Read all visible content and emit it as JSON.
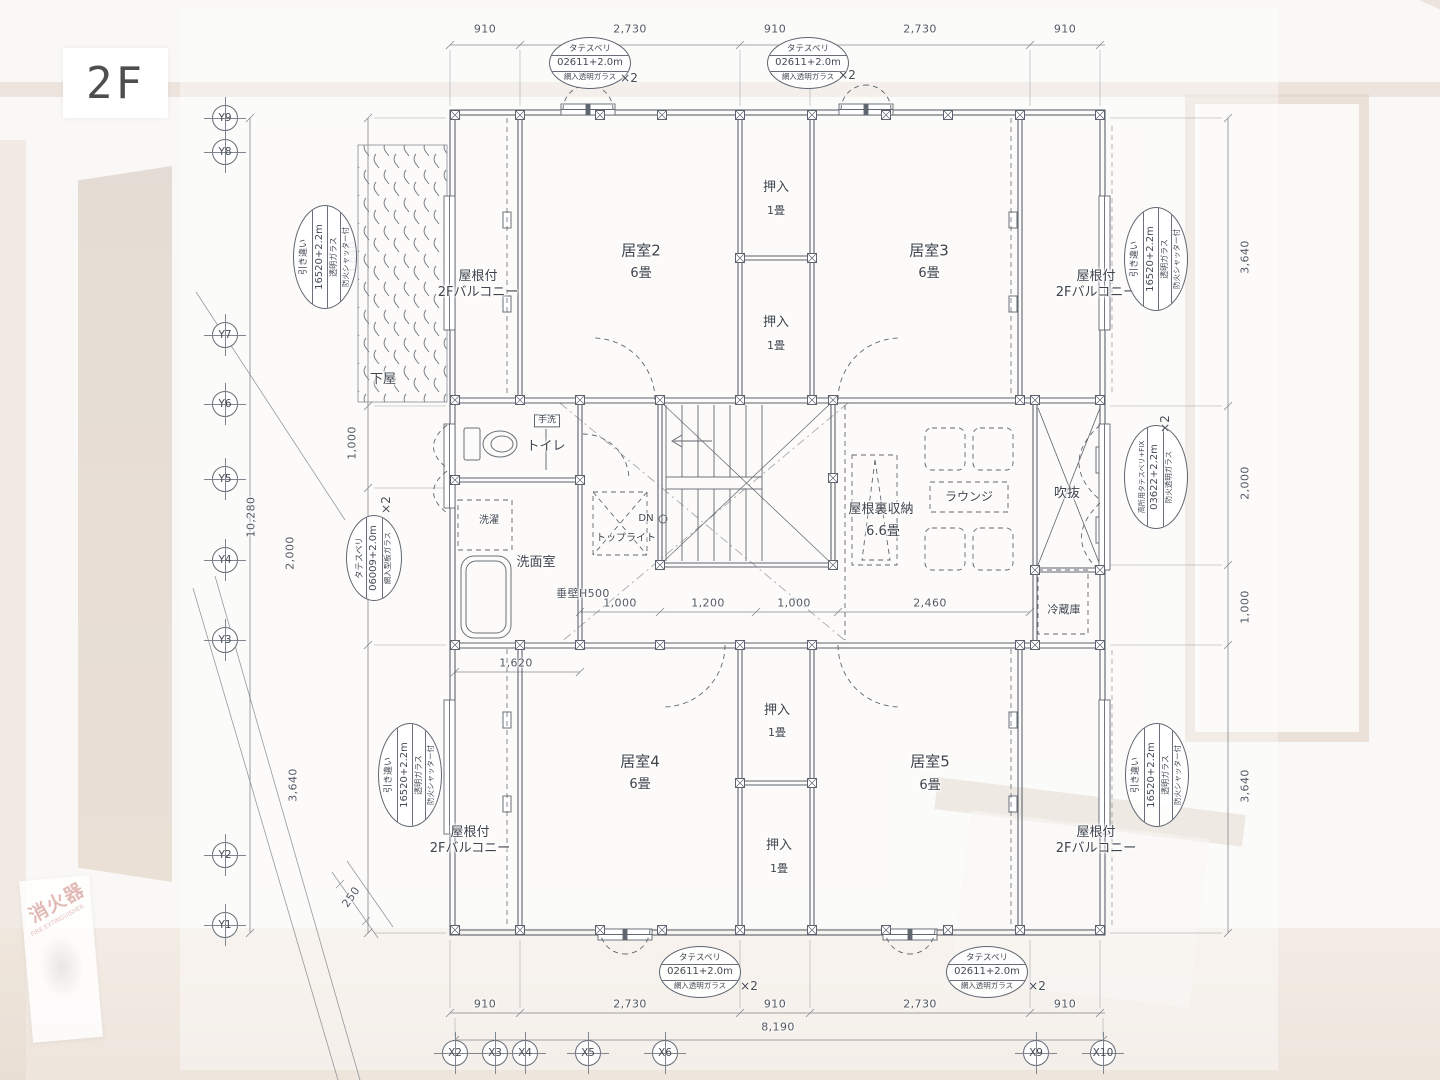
{
  "floor_label": "2F",
  "grid": {
    "y_labels": [
      "Y9",
      "Y8",
      "Y7",
      "Y6",
      "Y5",
      "Y4",
      "Y3",
      "Y2",
      "Y1"
    ],
    "x_labels": [
      "X2",
      "X3",
      "X4",
      "X5",
      "X6",
      "X9",
      "X10"
    ]
  },
  "dims": {
    "top": [
      "910",
      "2,730",
      "910",
      "2,730",
      "910"
    ],
    "bottom": [
      "910",
      "2,730",
      "910",
      "2,730",
      "910"
    ],
    "bottom_total": "8,190",
    "left": [
      "3,640",
      "1,000",
      "2,000",
      "3,640"
    ],
    "left_total": "10,280",
    "right": [
      "3,640",
      "2,000",
      "1,000",
      "3,640"
    ],
    "hall": [
      "1,000",
      "1,200",
      "1,000",
      "2,460"
    ],
    "closet_width": "1,620",
    "offset": "250",
    "tarekabe": "垂壁H500"
  },
  "rooms": {
    "room2": {
      "name": "居室2",
      "size": "6畳"
    },
    "room3": {
      "name": "居室3",
      "size": "6畳"
    },
    "room4": {
      "name": "居室4",
      "size": "6畳"
    },
    "room5": {
      "name": "居室5",
      "size": "6畳"
    },
    "closet": {
      "name": "押入",
      "size": "1畳"
    },
    "balcony": {
      "line1": "屋根付",
      "line2": "2Fバルコニー"
    },
    "geya": "下屋",
    "toilet": "トイレ",
    "handwash": "手洗",
    "laundry": "洗濯",
    "washroom": "洗面室",
    "toplight": "トップライト",
    "dn": "DN",
    "attic": {
      "name": "屋根裏収納",
      "size": "6.6畳"
    },
    "lounge": "ラウンジ",
    "void": "吹抜",
    "fridge": "冷蔵庫"
  },
  "stamps": {
    "tate_s": {
      "l1": "タテスベリ",
      "l2": "02611+2.0m",
      "l3": "網入透明ガラス",
      "mult": "×2"
    },
    "hiki": {
      "l1": "引き違い",
      "l2": "16520+2.2m",
      "l3": "透明ガラス",
      "l4": "防火シャッター付"
    },
    "tate_w": {
      "l1": "タテスベリ",
      "l2": "06009+2.0m",
      "l3": "網入型板ガラス",
      "mult": "×2"
    },
    "kosho": {
      "l1": "高所用タテスベリ+FIX",
      "l2": "03622+2.2m",
      "l3": "防火透明ガラス",
      "mult": "×2"
    }
  },
  "photo": {
    "fire_sign_title": "消火器",
    "fire_sign_sub": "FIRE EXTINGUISHER"
  }
}
